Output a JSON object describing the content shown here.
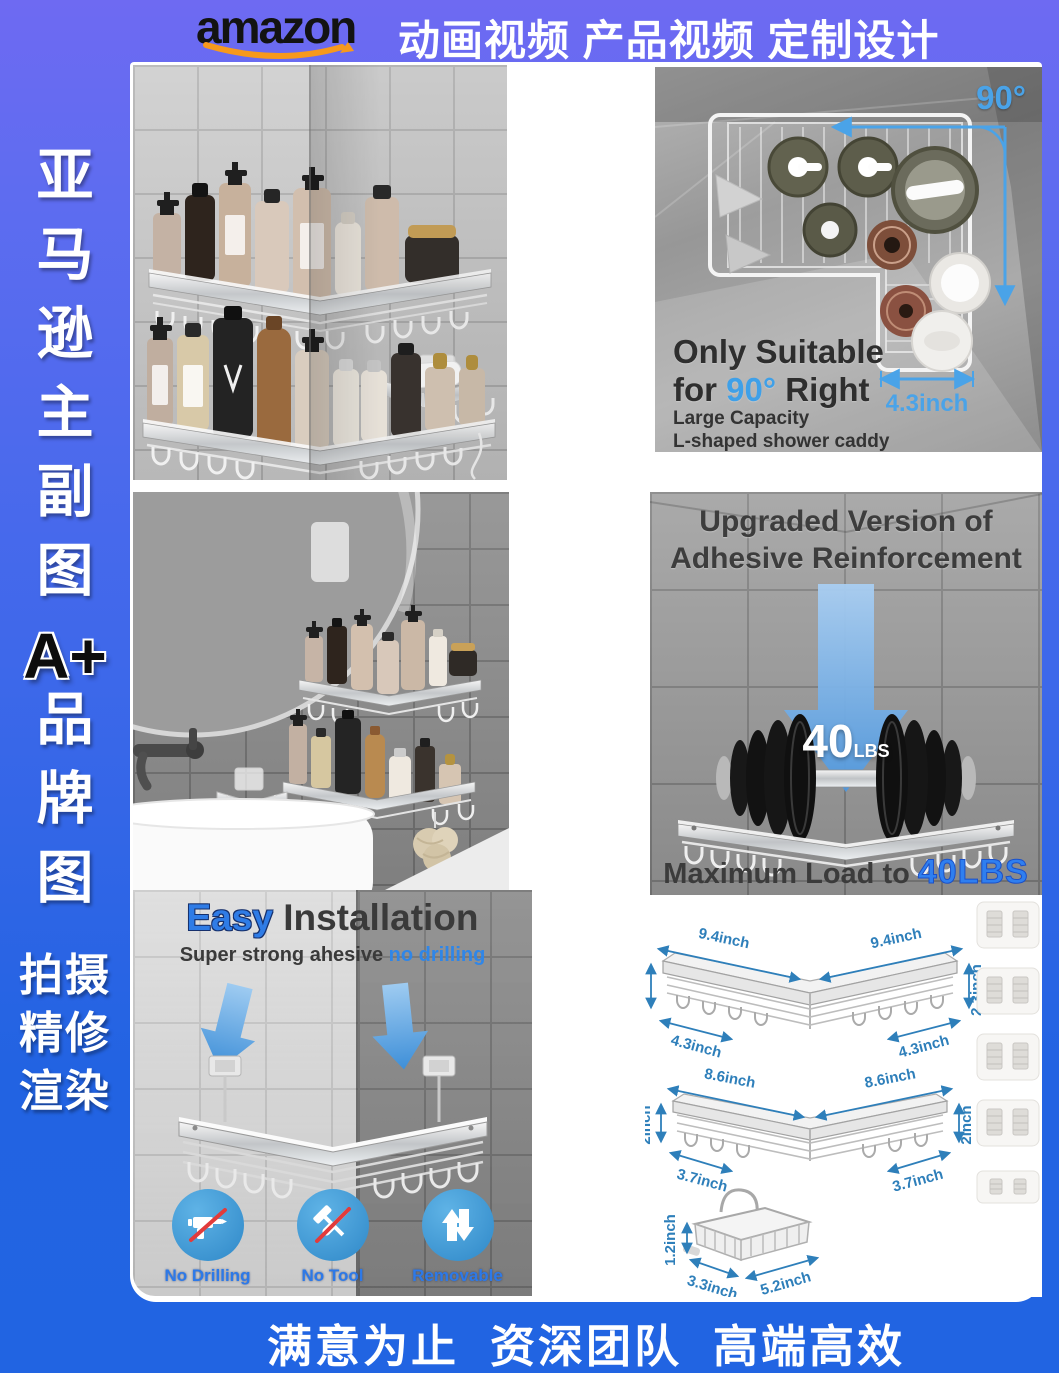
{
  "banner": {
    "logo": "amazon",
    "services": "动画视频 产品视频 定制设计"
  },
  "sidebar": {
    "top": [
      "亚",
      "马",
      "逊",
      "主",
      "副",
      "图"
    ],
    "aplus": "A+",
    "mid": [
      "品",
      "牌",
      "图"
    ],
    "bottom": [
      "拍摄",
      "精修",
      "渲染"
    ]
  },
  "photo_top_right": {
    "angle": "90°",
    "title1": "Only Suitable",
    "title2_pre": "for ",
    "title2_blue": "90°",
    "title2_post": " Right",
    "sub1": "Large Capacity",
    "sub2": "L-shaped shower caddy",
    "dim": "4.3inch"
  },
  "photo_mid_right": {
    "title1": "Upgraded Version of",
    "title2": "Adhesive Reinforcement",
    "arrow_num": "40",
    "arrow_unit": "LBS",
    "load_pre": "Maximum Load to ",
    "load_value": "40LBS"
  },
  "photo_bottom_left": {
    "title_blue": "Easy",
    "title_rest": " Installation",
    "sub_pre": "Super strong ahesive ",
    "sub_blue": "no drilling",
    "badges": [
      {
        "label": "No Drilling"
      },
      {
        "label": "No Tool"
      },
      {
        "label": "Removable"
      }
    ]
  },
  "diagrams": {
    "large": {
      "width_l": "9.4inch",
      "width_r": "9.4inch",
      "height_l": "2.3inch",
      "height_r": "2.3inch",
      "depth_l": "4.3inch",
      "depth_r": "4.3inch"
    },
    "small": {
      "width_l": "8.6inch",
      "width_r": "8.6inch",
      "height_l": "2inch",
      "height_r": "2inch",
      "depth_l": "3.7inch",
      "depth_r": "3.7inch"
    },
    "basket": {
      "height": "1.2inch",
      "width": "3.3inch",
      "length": "5.2inch"
    }
  },
  "footer": {
    "slogan": "满意为止  资深团队  高端高效"
  },
  "colors": {
    "banner_bg": "#6b6bf2",
    "footer_bg": "#2263e2",
    "accent_blue": "#2e7fba",
    "highlight_blue": "#2f7ce6",
    "badge_blue": "#3f9ad2",
    "logo_swoosh": "#f7991c"
  }
}
